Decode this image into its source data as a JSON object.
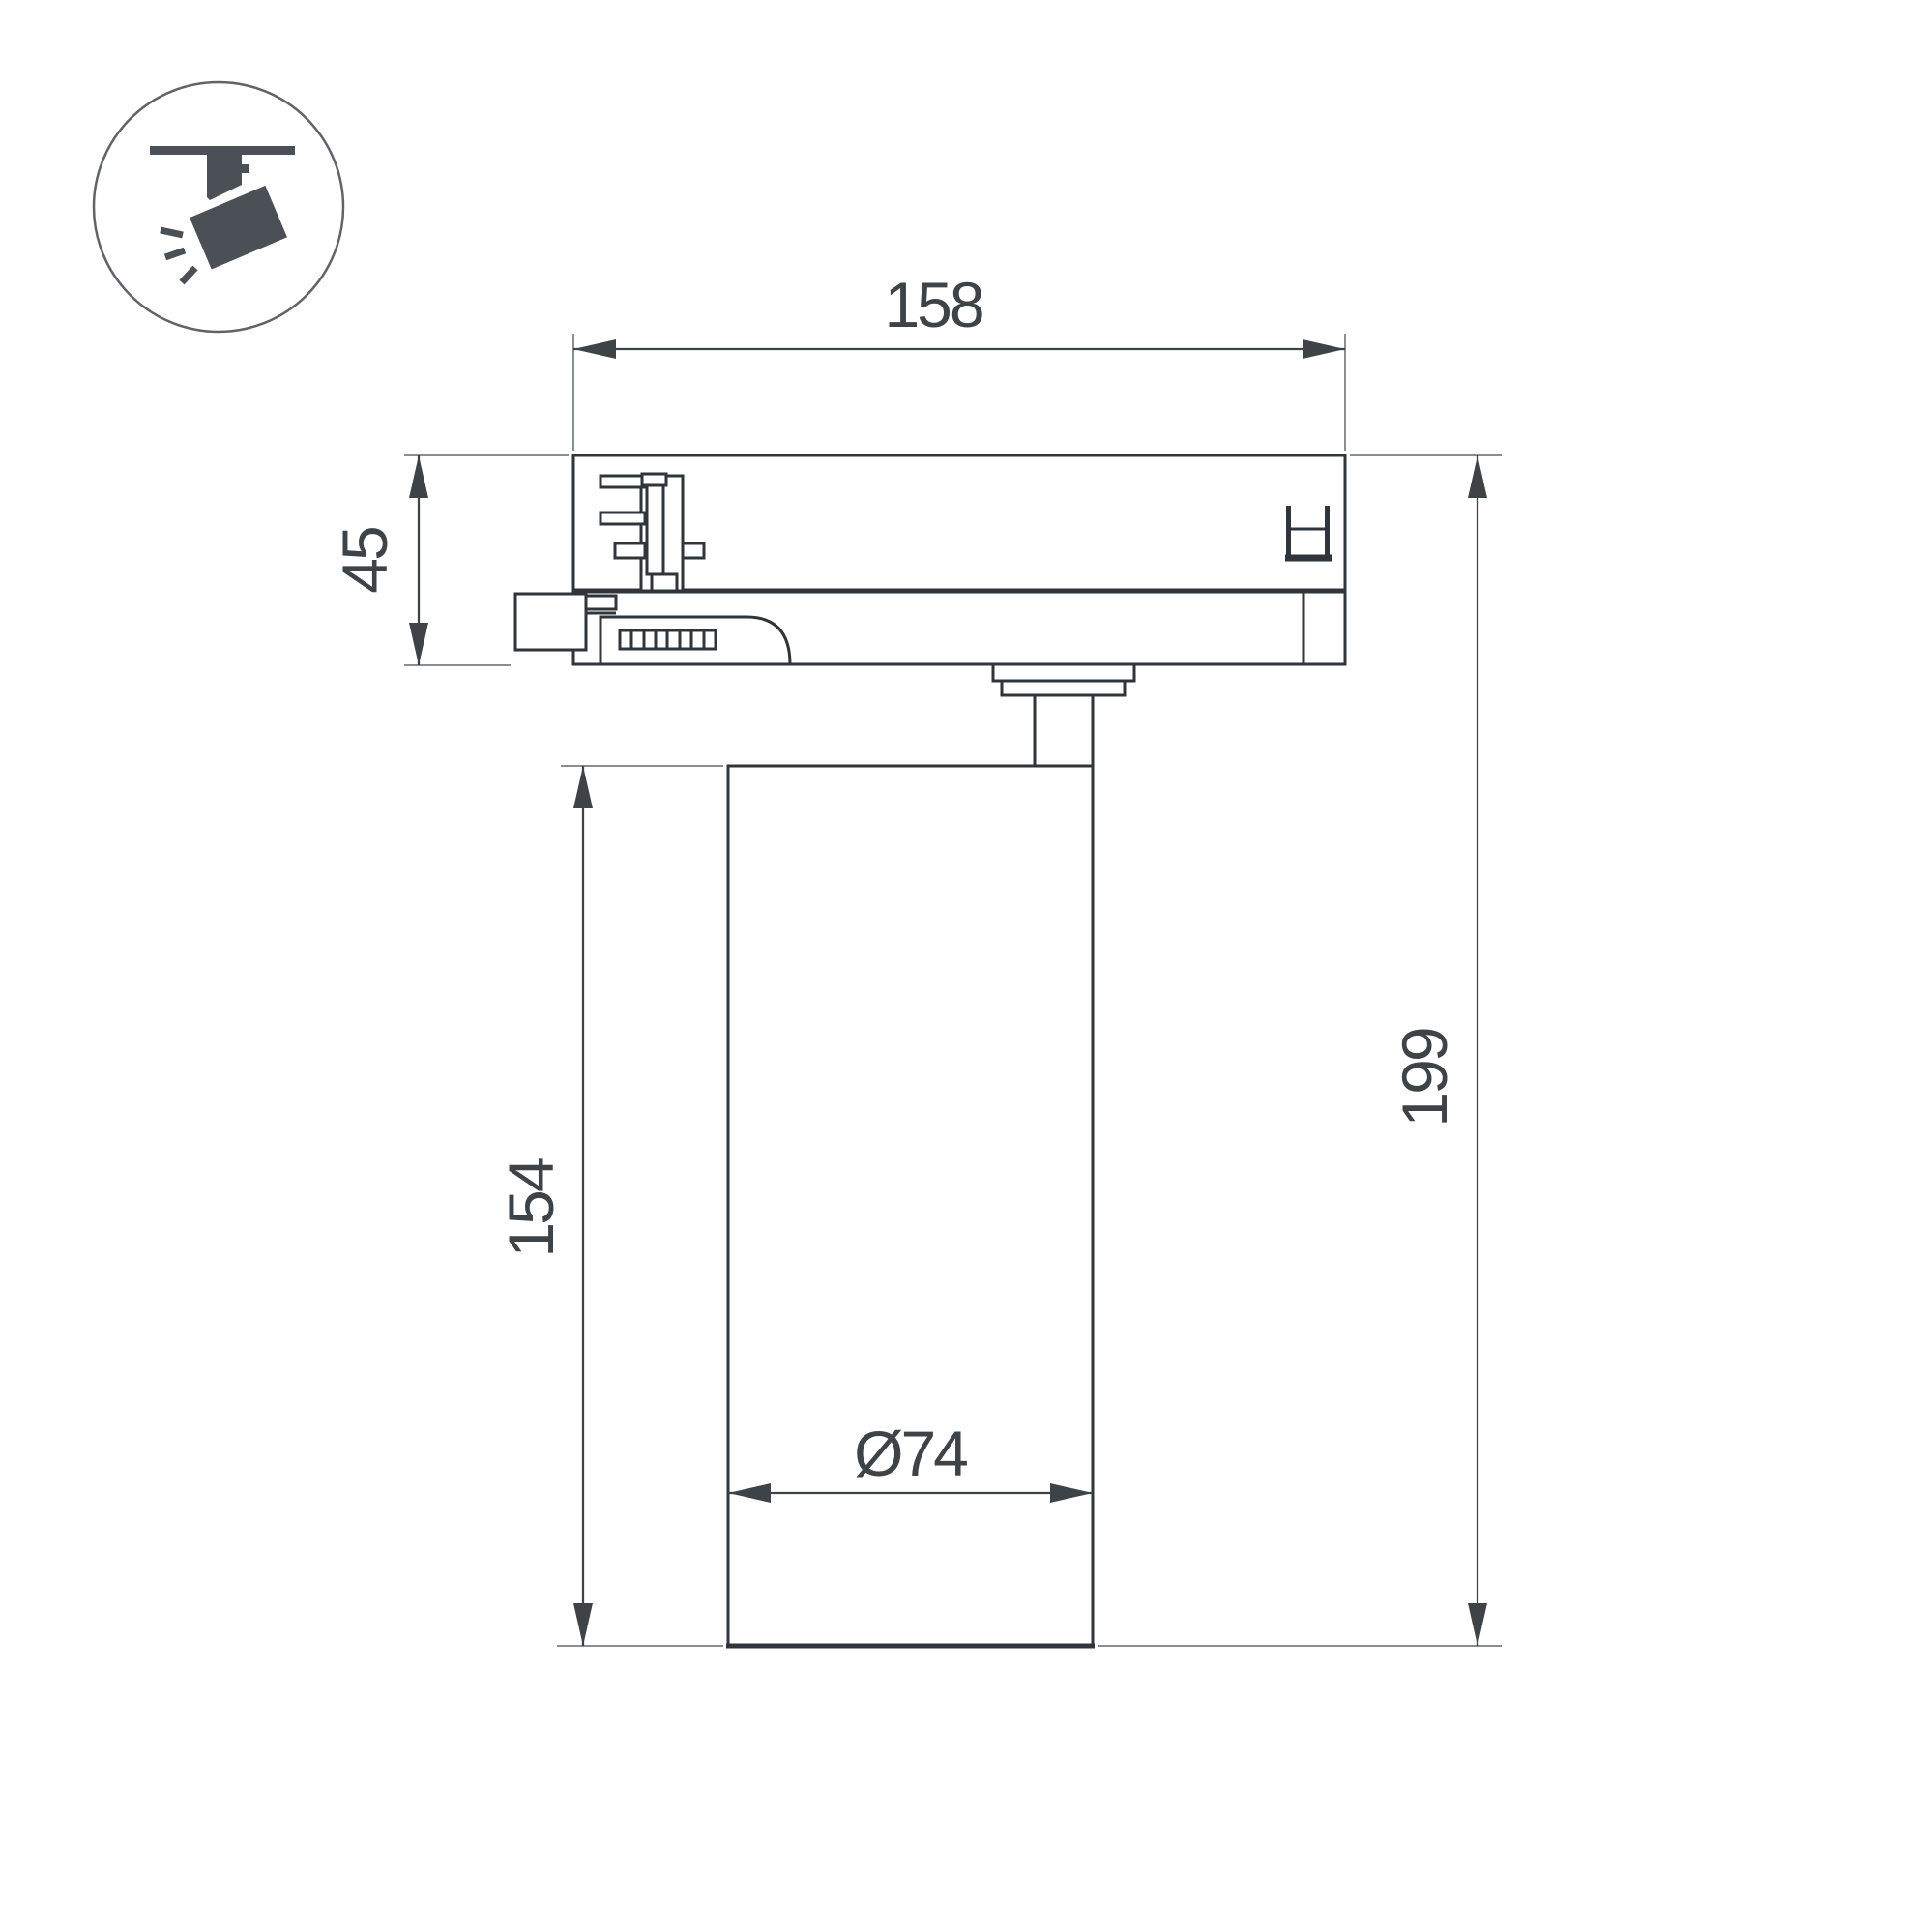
{
  "drawing": {
    "description": "Dimensional technical drawing of a track-mounted spotlight (side view)",
    "dimensions": {
      "adapter_width": "158",
      "adapter_height": "45",
      "body_height": "154",
      "total_height": "199",
      "body_diameter": "Ø74"
    }
  },
  "icon": {
    "name": "track-spotlight"
  },
  "colors": {
    "background": "#ffffff",
    "part_outline": "#2f353a",
    "dimension_color": "#3e4347",
    "extension_line_color": "#8b8e91",
    "icon_color": "#4a5056",
    "icon_circle_stroke": "#606468"
  }
}
